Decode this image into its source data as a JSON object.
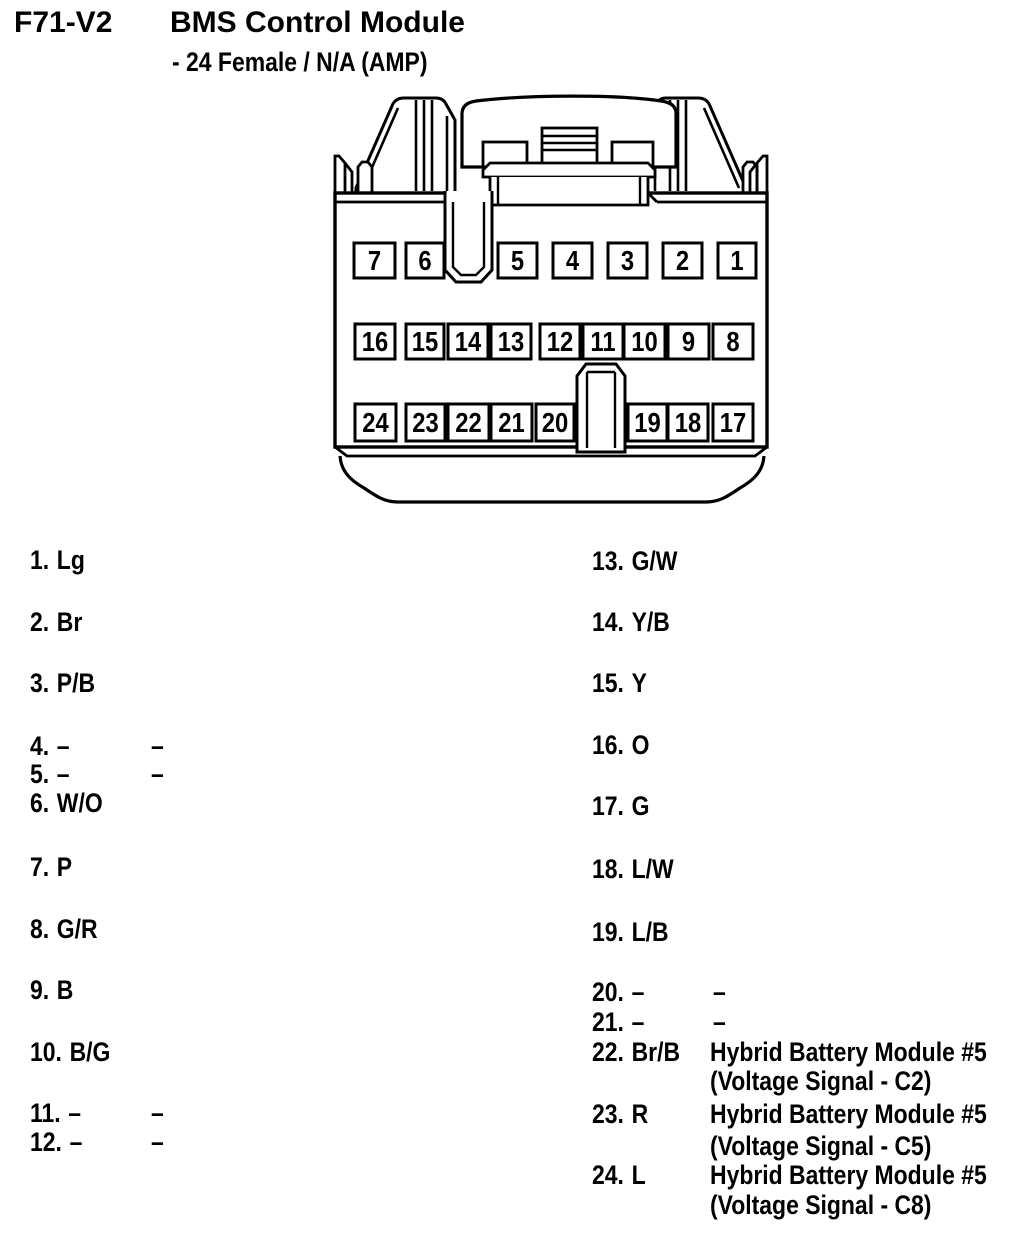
{
  "style": {
    "ink": "#000000",
    "paper": "#ffffff"
  },
  "header": {
    "connector_id": "F71-V2",
    "title": "BMS Control Module",
    "subtitle": "- 24 Female / N/A (AMP)"
  },
  "connector_view": {
    "description": "24-pin female connector face drawing",
    "pin_rows": [
      [
        "7",
        "6",
        "5",
        "4",
        "3",
        "2",
        "1"
      ],
      [
        "16",
        "15",
        "14",
        "13",
        "12",
        "11",
        "10",
        "9",
        "8"
      ],
      [
        "24",
        "23",
        "22",
        "21",
        "20",
        "19",
        "18",
        "17"
      ]
    ]
  },
  "pinout": {
    "left": [
      {
        "num": "1.",
        "color": "Lg"
      },
      {
        "num": "2.",
        "color": "Br"
      },
      {
        "num": "3.",
        "color": "P/B"
      },
      {
        "num": "4.",
        "color": "–",
        "dash": "–"
      },
      {
        "num": "5.",
        "color": "–",
        "dash": "–"
      },
      {
        "num": "6.",
        "color": "W/O"
      },
      {
        "num": "7.",
        "color": "P"
      },
      {
        "num": "8.",
        "color": "G/R"
      },
      {
        "num": "9.",
        "color": "B"
      },
      {
        "num": "10.",
        "color": "B/G"
      },
      {
        "num": "11.",
        "color": "–",
        "dash": "–"
      },
      {
        "num": "12.",
        "color": "–",
        "dash": "–"
      }
    ],
    "right": [
      {
        "num": "13.",
        "color": "G/W"
      },
      {
        "num": "14.",
        "color": "Y/B"
      },
      {
        "num": "15.",
        "color": "Y"
      },
      {
        "num": "16.",
        "color": "O"
      },
      {
        "num": "17.",
        "color": "G"
      },
      {
        "num": "18.",
        "color": "L/W"
      },
      {
        "num": "19.",
        "color": "L/B"
      },
      {
        "num": "20.",
        "color": "–",
        "dash": "–"
      },
      {
        "num": "21.",
        "color": "–",
        "dash": "–"
      },
      {
        "num": "22.",
        "color": "Br/B",
        "remark": "Hybrid Battery Module #5"
      },
      {
        "remark": "(Voltage Signal - C2)"
      },
      {
        "num": "23.",
        "color": "R",
        "remark": "Hybrid Battery Module #5"
      },
      {
        "remark": "(Voltage Signal - C5)"
      },
      {
        "num": "24.",
        "color": "L",
        "remark": "Hybrid Battery Module #5"
      },
      {
        "remark": "(Voltage Signal - C8)"
      }
    ]
  }
}
